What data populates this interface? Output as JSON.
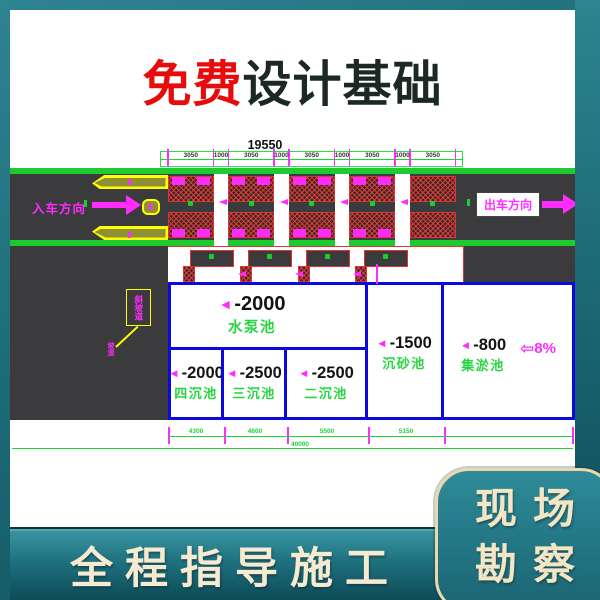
{
  "title": {
    "highlight": "免费",
    "rest": "设计基础"
  },
  "drawing": {
    "total_dim": "19550",
    "segments": [
      "3050",
      "1000",
      "3050",
      "1000",
      "3050",
      "1000",
      "3050",
      "1000",
      "3050"
    ],
    "entry_label": "入车方向",
    "exit_label": "出车方向",
    "ramp_tag": "斜坡道",
    "ramp_note": "坡道",
    "level_arrow": "◄",
    "slope_arrow": "⇦",
    "slope_label": "8%",
    "tanks": {
      "pump": {
        "level": "-2000",
        "name": "水泵池"
      },
      "fourth": {
        "level": "-2000",
        "name": "四沉池"
      },
      "third": {
        "level": "-2500",
        "name": "三沉池"
      },
      "second": {
        "level": "-2500",
        "name": "二沉池"
      },
      "grit": {
        "level": "-1500",
        "name": "沉砂池"
      },
      "silt": {
        "level": "-800",
        "name": "集淤池"
      }
    },
    "bottom_dims": [
      "4300",
      "4600",
      "5500",
      "5150"
    ],
    "overall_dim": "40000"
  },
  "banners": {
    "bottom_left": "全程指导施工",
    "bottom_right_lines": [
      "现场",
      "勘察"
    ]
  },
  "colors": {
    "teal": "#1c6a77",
    "magenta": "#ff2bff",
    "cad_green": "#1fd434",
    "tank_blue": "#0a0ae0",
    "hatch_red": "#e23333",
    "road_gray": "#3b3b3d",
    "cream": "#f4e6c4",
    "title_red": "#e80b0b"
  }
}
